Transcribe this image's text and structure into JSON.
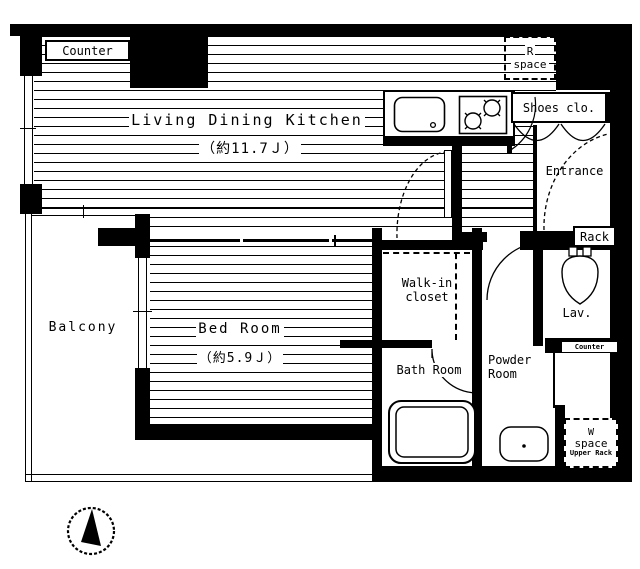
{
  "rooms": {
    "ldk": {
      "label": "Living Dining Kitchen",
      "size": "（約11.7Ｊ）"
    },
    "bedroom": {
      "label": "Bed Room",
      "size": "（約5.9Ｊ）"
    },
    "balcony": {
      "label": "Balcony"
    },
    "entrance": {
      "label": "Entrance"
    },
    "shoes_closet": {
      "label": "Shoes clo."
    },
    "walk_in_closet": {
      "line1": "Walk-in",
      "line2": "closet"
    },
    "bath_room": {
      "label": "Bath Room"
    },
    "powder_room": {
      "line1": "Powder",
      "line2": "Room"
    },
    "lavatory": {
      "label": "Lav."
    },
    "rack": {
      "label": "Rack"
    },
    "kitchen_counter": {
      "label": "Counter"
    },
    "lav_counter": {
      "label": "Counter"
    },
    "r_space": {
      "line1": "R",
      "line2": "space"
    },
    "w_space": {
      "line1": "W",
      "line2": "space",
      "line3": "Upper Rack"
    }
  },
  "icons": {
    "compass": "north-arrow",
    "sink": "kitchen-sink",
    "stove": "two-burner-stove",
    "toilet": "toilet",
    "bathtub": "bathtub",
    "washbasin": "washbasin"
  },
  "colors": {
    "line": "#000000",
    "background": "#ffffff"
  }
}
